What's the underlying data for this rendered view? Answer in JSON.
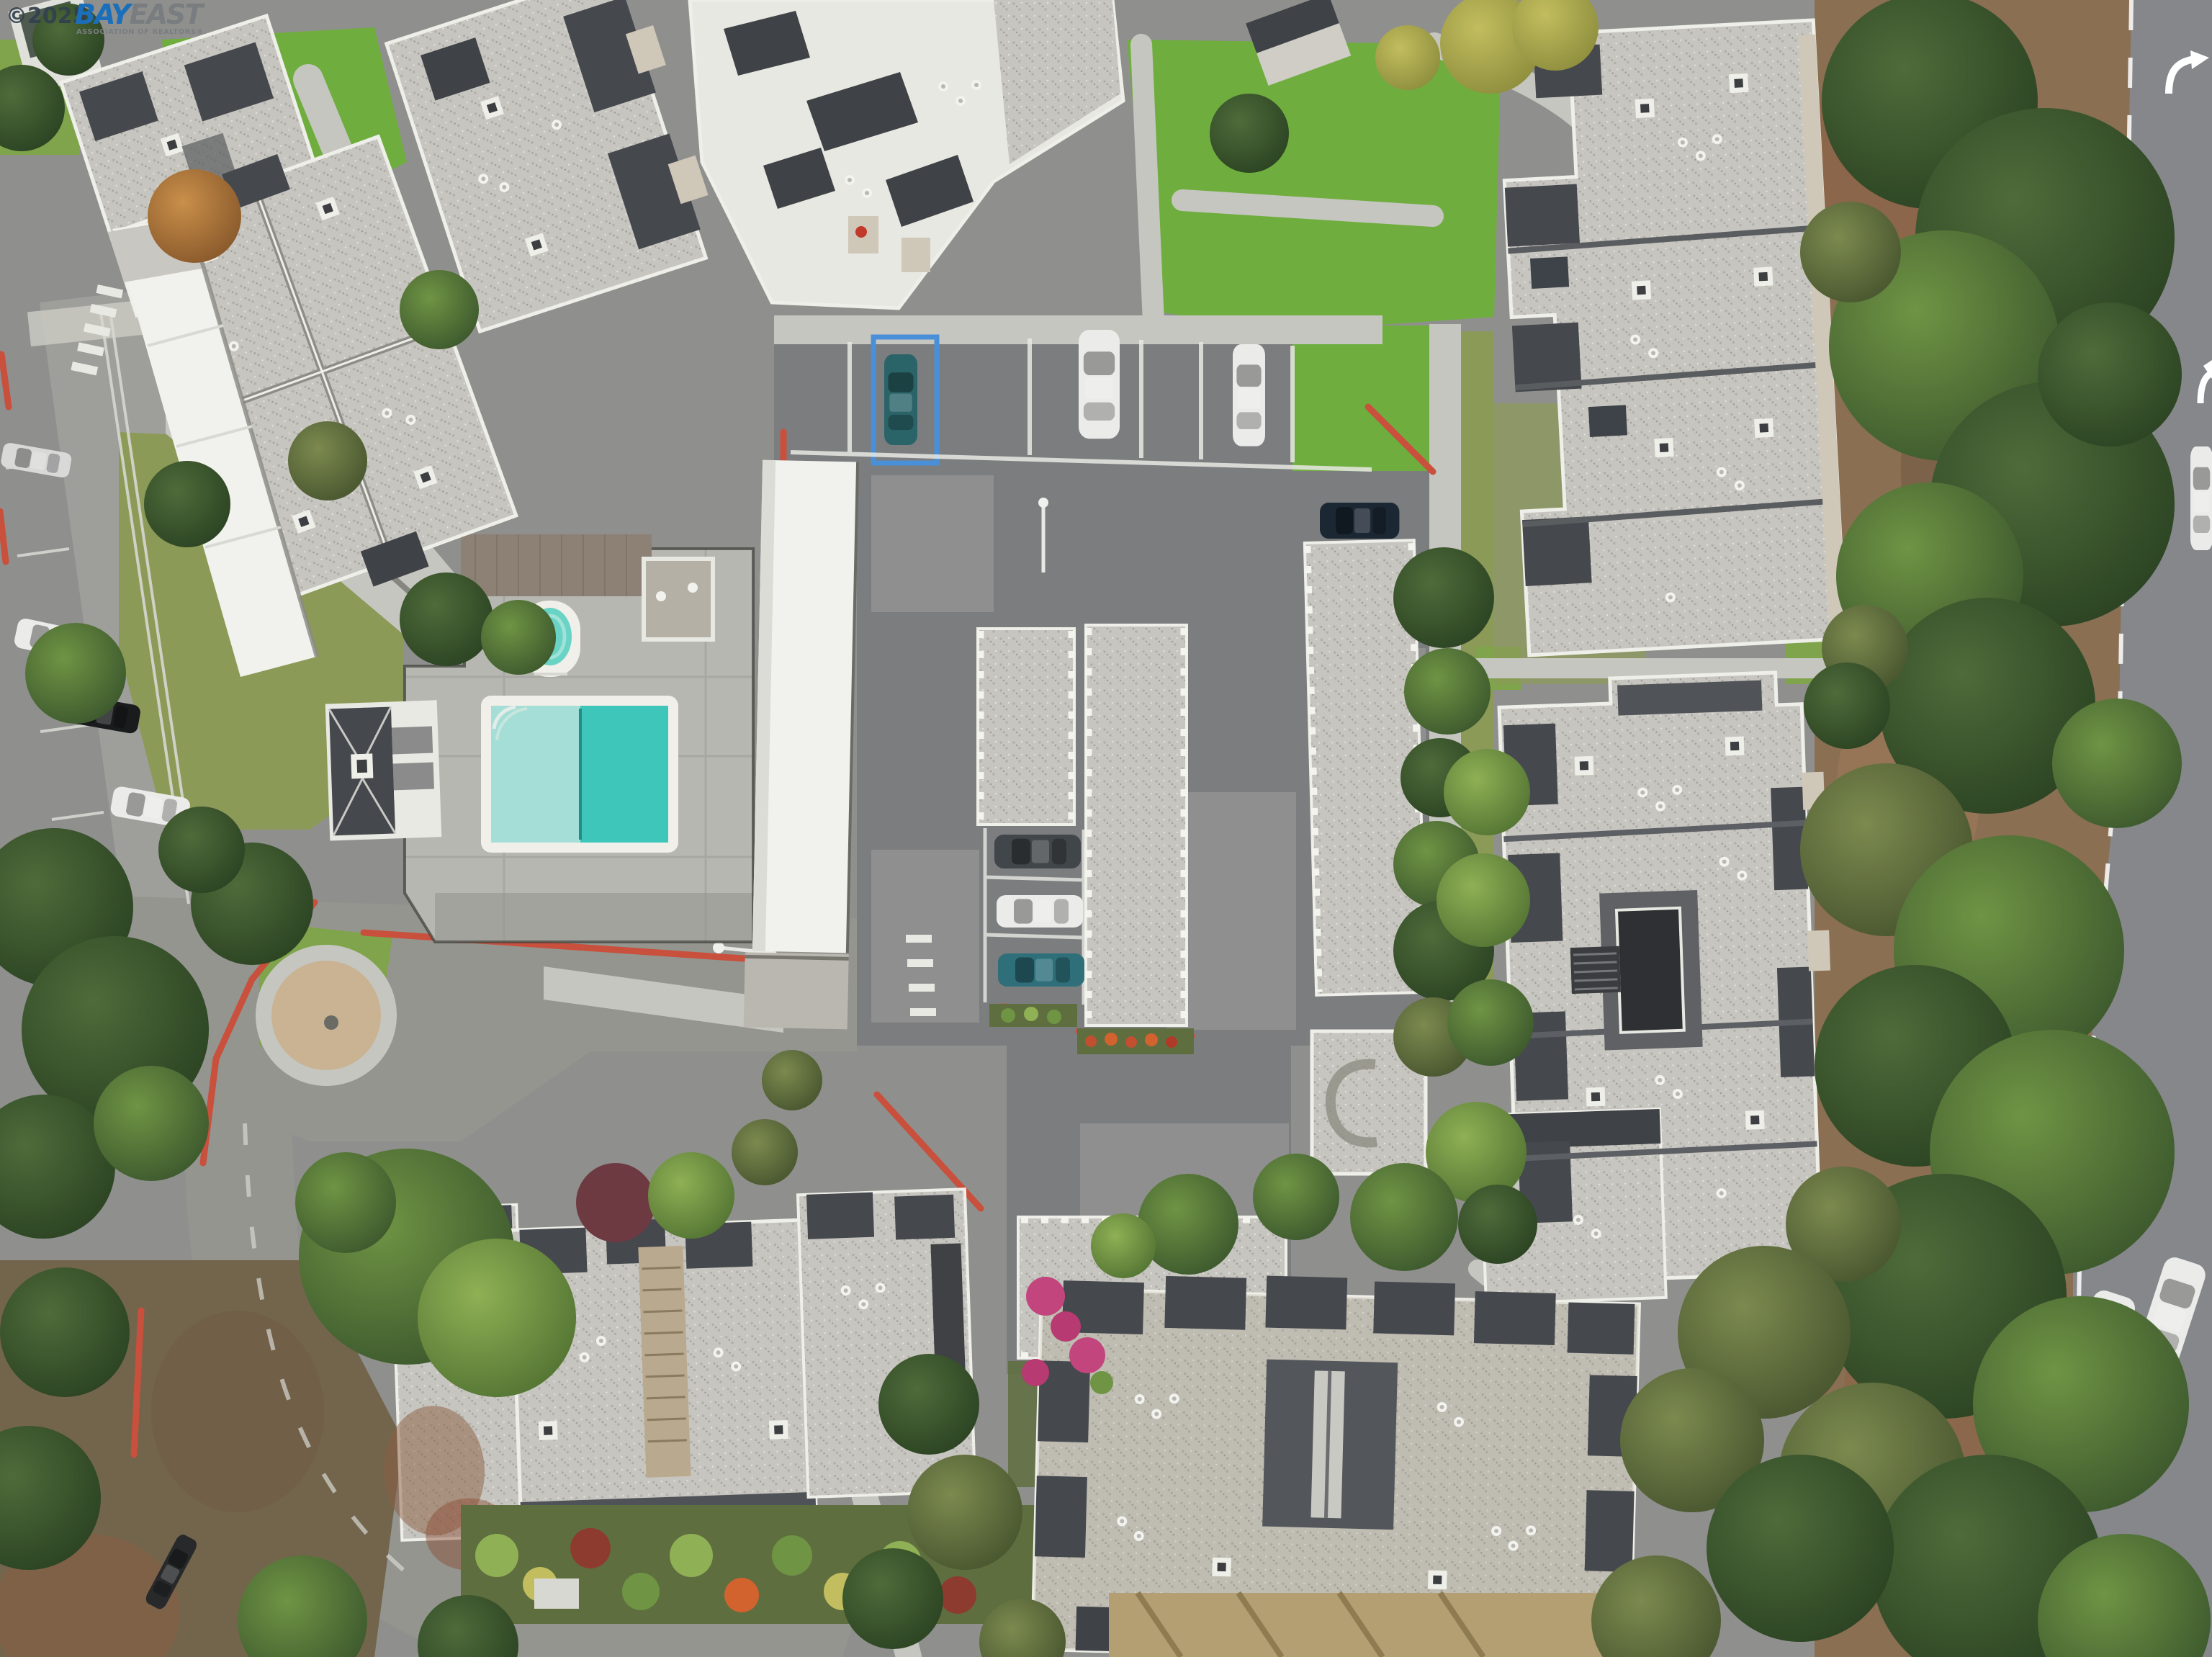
{
  "meta": {
    "type": "aerial-photograph",
    "description": "Overhead drone photo of a condominium complex: gray shingle roofs with white trim, central parking lot with carport rows and parked cars, swimming pool with spa and pool house, red-painted curbs, lawns, a eucalyptus tree belt and a public road on the right edge."
  },
  "watermark": {
    "copyright": "©2025",
    "brand_primary": "BAY",
    "brand_secondary": "EAST",
    "subtitle": "ASSOCIATION OF REALTORS®"
  },
  "scene": {
    "objects": [
      "swimming-pool",
      "spa",
      "pool-house",
      "pool-deck",
      "carport-row",
      "parking-lot",
      "parked-cars",
      "condo-buildings",
      "red-curbs",
      "pebble-circle",
      "tree-belt",
      "right-road",
      "road-arrow-markings",
      "lawns",
      "dirt-slope",
      "flower-beds"
    ]
  },
  "palette": {
    "asphalt": "#8f908e",
    "asphaltDark": "#7b7d7f",
    "asphaltLight": "#9e9f9b",
    "roadRight": "#85878a",
    "roadPlaza": "#94958f",
    "concrete": "#c6c6c0",
    "concreteBright": "#d7d7d1",
    "roofLight": "#c7c5bf",
    "roofLightDot": "#b0aea8",
    "roofMid": "#b5b3ad",
    "roofDark": "#45484d",
    "roofSlate": "#3f4246",
    "trim": "#efefe9",
    "wallTan": "#cfc7b8",
    "stairTan": "#b9a98e",
    "whiteRoof": "#f1f1ed",
    "poolDeck": "#b7b7b2",
    "poolBorder": "#f0efe9",
    "poolLight": "#a5ded7",
    "poolDeep": "#3ec6ba",
    "spa": "#69d3c6",
    "laneLine": "#1f8e84",
    "grass": "#7fa44b",
    "grassBright": "#6fae3e",
    "grassOlive": "#8c9a58",
    "gardenDark": "#5f6e3f",
    "treeDark1": "#4f6b3a",
    "treeDark2": "#2c4423",
    "treeMid1": "#6f9444",
    "treeMid2": "#3e5a2e",
    "treeBright1": "#8fb054",
    "treeBright2": "#557634",
    "treeOlive1": "#7c8a4f",
    "treeOlive2": "#4a5730",
    "treeYellow1": "#c2bd5e",
    "treeYellow2": "#8f8f3e",
    "autumn1": "#c98f4a",
    "autumn2": "#8a5a2c",
    "dirt": "#8a6f52",
    "dirtDark": "#6e563f",
    "dirtLight": "#9c7a58",
    "mulchRed": "#8b5e41",
    "brush": "#73654c",
    "dryGrass": "#b39f72",
    "dryStreak": "#8f7b50",
    "curbRed": "#c8503c",
    "stallBlue": "#4a90d9",
    "markWhite": "#e9e9e4",
    "carWhite": "#ebebe9",
    "carTeal": "#2a6468",
    "carTealMid": "#2e6f7a",
    "carDarkBlue": "#1b2732",
    "carBlack": "#1a1b1d",
    "carGray": "#41464a",
    "flowerPink": "#c2457e",
    "flowerRed": "#c14f30",
    "flowerOrange": "#d2622e",
    "maroon": "#6e3a42",
    "woodDeck": "#8c8174",
    "gravelRoof": "#b4b0a6",
    "pebble": "#c9b393",
    "wmBlue": "#1b6fba",
    "wmGray": "#7a7d80",
    "wmDark": "#32404e"
  }
}
